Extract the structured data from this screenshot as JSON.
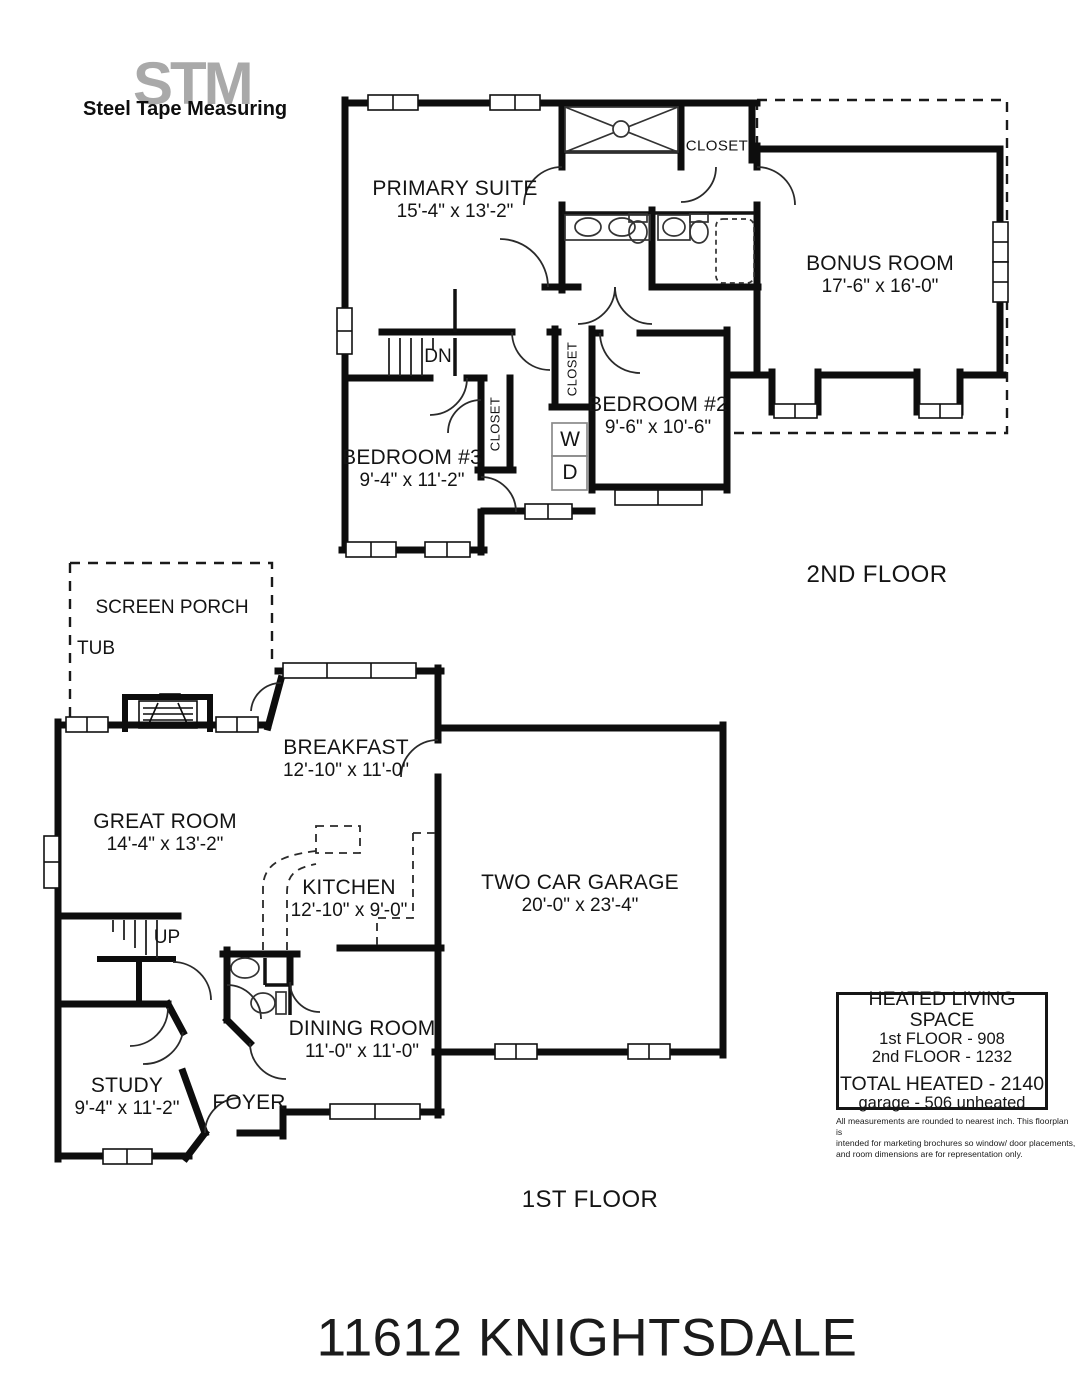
{
  "logo": {
    "monogram": "STM",
    "name": "Steel Tape Measuring"
  },
  "second_floor": {
    "floor_label": "2ND FLOOR",
    "primary_suite": {
      "name": "PRIMARY SUITE",
      "dims": "15'-4\" x 13'-2\""
    },
    "bonus_room": {
      "name": "BONUS ROOM",
      "dims": "17'-6\" x 16'-0\""
    },
    "bedroom2": {
      "name": "BEDROOM #2",
      "dims": "9'-6\" x 10'-6\""
    },
    "bedroom3": {
      "name": "BEDROOM #3",
      "dims": "9'-4\" x 11'-2\""
    },
    "closet_primary": "CLOSET",
    "closet_hall": "CLOSET",
    "closet_bedroom2": "CLOSET",
    "washer": "W",
    "dryer": "D",
    "stairs": "DN"
  },
  "first_floor": {
    "floor_label": "1ST FLOOR",
    "screen_porch": "SCREEN PORCH",
    "tub": "TUB",
    "great_room": {
      "name": "GREAT ROOM",
      "dims": "14'-4\" x 13'-2\""
    },
    "breakfast": {
      "name": "BREAKFAST",
      "dims": "12'-10\" x 11'-0\""
    },
    "kitchen": {
      "name": "KITCHEN",
      "dims": "12'-10\" x 9'-0\""
    },
    "garage": {
      "name": "TWO CAR GARAGE",
      "dims": "20'-0\" x 23'-4\""
    },
    "dining_room": {
      "name": "DINING ROOM",
      "dims": "11'-0\" x 11'-0\""
    },
    "study": {
      "name": "STUDY",
      "dims": "9'-4\" x 11'-2\""
    },
    "foyer": "FOYER",
    "stairs": "UP"
  },
  "summary": {
    "heading": "HEATED LIVING SPACE",
    "first_floor": "1st FLOOR - 908",
    "second_floor": "2nd FLOOR - 1232",
    "total": "TOTAL HEATED - 2140",
    "garage": "garage - 506 unheated"
  },
  "disclaimer": {
    "line1": "All measurements are rounded to nearest inch. This floorplan is",
    "line2": "intended for marketing brochures so window/ door placements,",
    "line3": "and room dimensions are for representation only."
  },
  "address_title": "11612 KNIGHTSDALE"
}
